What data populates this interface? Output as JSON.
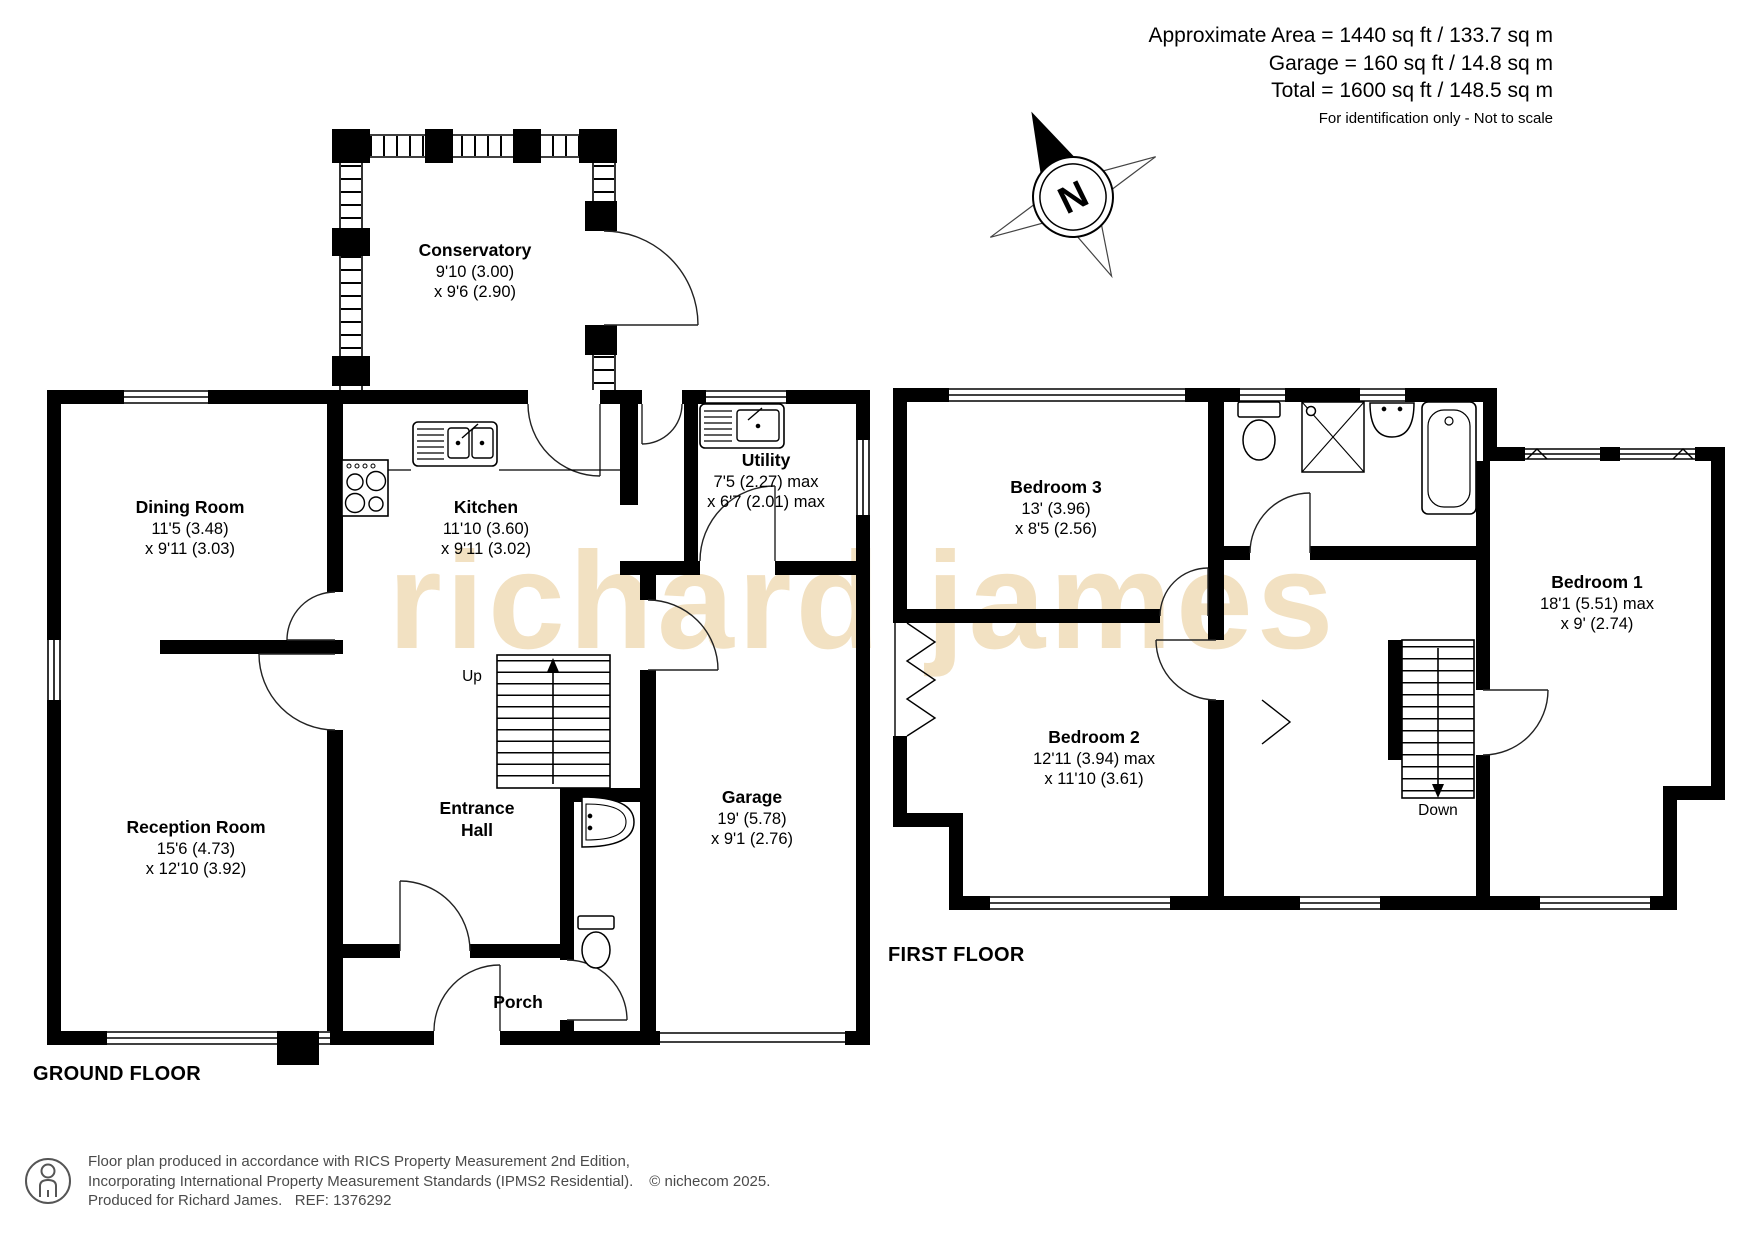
{
  "header": {
    "lines": [
      "Approximate Area = 1440 sq ft / 133.7 sq m",
      "Garage = 160 sq ft / 14.8 sq m",
      "Total = 1600 sq ft / 148.5 sq m"
    ],
    "disclaimer": "For identification only - Not to scale"
  },
  "compass": {
    "label": "N"
  },
  "watermark": "richard james",
  "floors": {
    "ground": {
      "title": "GROUND FLOOR",
      "stairs_label": "Up",
      "rooms": [
        {
          "name": "Conservatory",
          "dim1": "9'10 (3.00)",
          "dim2": "x 9'6 (2.90)"
        },
        {
          "name": "Dining Room",
          "dim1": "11'5 (3.48)",
          "dim2": "x 9'11 (3.03)"
        },
        {
          "name": "Kitchen",
          "dim1": "11'10 (3.60)",
          "dim2": "x 9'11 (3.02)"
        },
        {
          "name": "Utility",
          "dim1": "7'5 (2.27) max",
          "dim2": "x 6'7 (2.01) max"
        },
        {
          "name": "Entrance Hall"
        },
        {
          "name": "Reception Room",
          "dim1": "15'6 (4.73)",
          "dim2": "x 12'10 (3.92)"
        },
        {
          "name": "Garage",
          "dim1": "19' (5.78)",
          "dim2": "x 9'1 (2.76)"
        },
        {
          "name": "Porch"
        }
      ]
    },
    "first": {
      "title": "FIRST FLOOR",
      "stairs_label": "Down",
      "rooms": [
        {
          "name": "Bedroom 3",
          "dim1": "13' (3.96)",
          "dim2": "x 8'5 (2.56)"
        },
        {
          "name": "Bedroom 2",
          "dim1": "12'11 (3.94) max",
          "dim2": "x 11'10 (3.61)"
        },
        {
          "name": "Bedroom 1",
          "dim1": "18'1 (5.51) max",
          "dim2": "x 9' (2.74)"
        }
      ]
    }
  },
  "footer": {
    "line1": "Floor plan produced in accordance with RICS Property Measurement 2nd Edition,",
    "line2": "Incorporating International Property Measurement Standards (IPMS2 Residential).",
    "copyright": "© nichecom 2025.",
    "line3": "Produced for Richard James.   REF: 1376292"
  },
  "colors": {
    "wall": "#000000",
    "watermark": "#f2e1c2"
  }
}
